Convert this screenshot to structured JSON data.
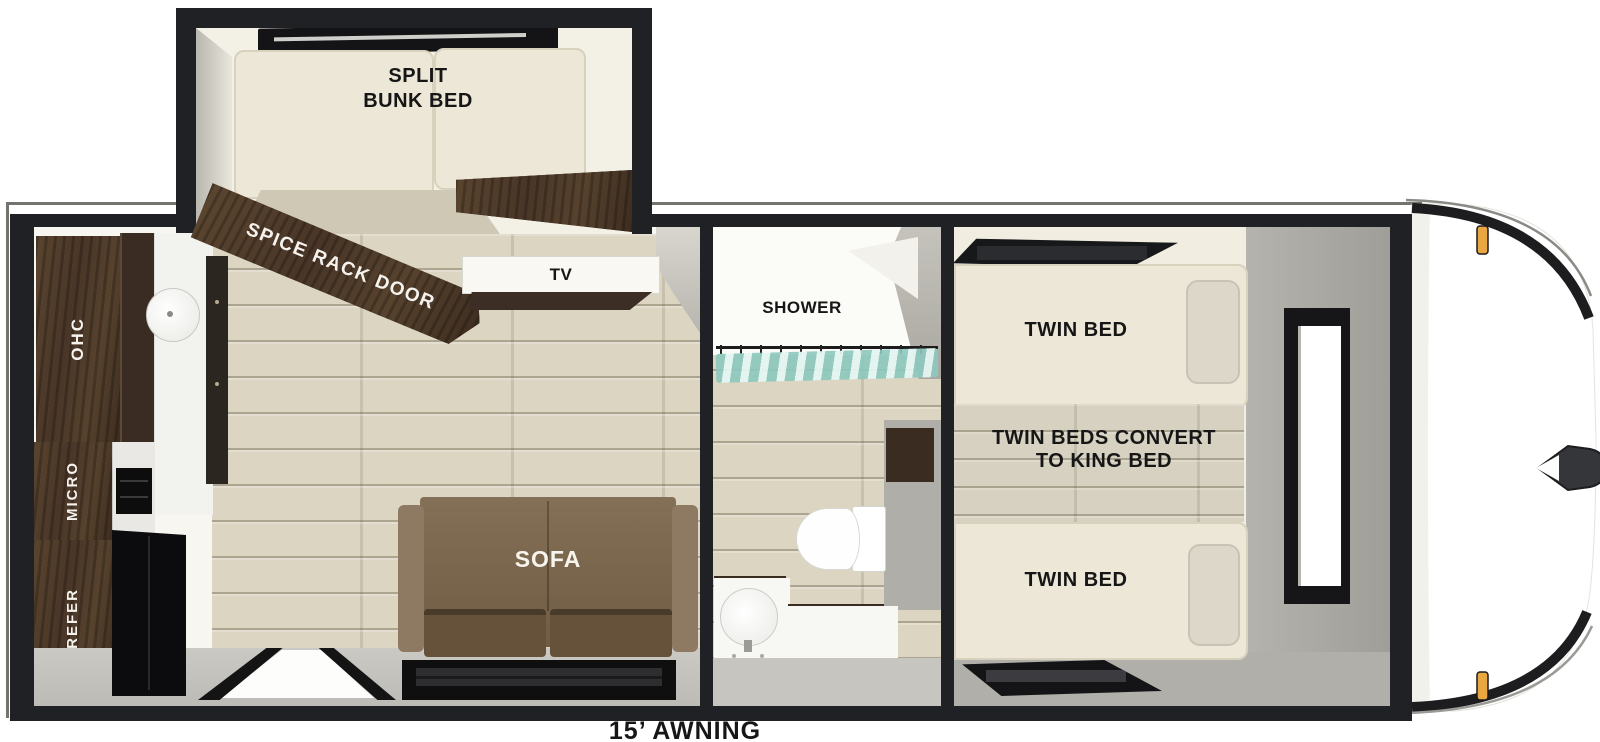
{
  "floorplan": {
    "bunk_room": {
      "label_line1": "SPLIT",
      "label_line2": "BUNK BED",
      "spice_rack_label": "SPICE RACK DOOR"
    },
    "living": {
      "tv_label": "TV",
      "sofa_label": "SOFA"
    },
    "kitchen": {
      "ohc_label": "OHC",
      "micro_label": "MICRO",
      "refer_label": "REFER"
    },
    "bath": {
      "shower_label": "SHOWER"
    },
    "bedroom": {
      "twin_bed_top_label": "TWIN BED",
      "convert_line1": "TWIN BEDS CONVERT",
      "convert_line2": "TO KING BED",
      "twin_bed_bottom_label": "TWIN BED"
    },
    "awning_label": "15’ AWNING",
    "colors": {
      "wall_black": "#202124",
      "wood_floor": "#dbd5c2",
      "dark_wood": "#4e3a2b",
      "sofa_brown": "#7c6950",
      "curtain_teal": "#a9d8cd",
      "marker_amber": "#e8a741",
      "bedroom_gray": "#aeaca6",
      "mattress_cream": "#ece7d6"
    }
  }
}
